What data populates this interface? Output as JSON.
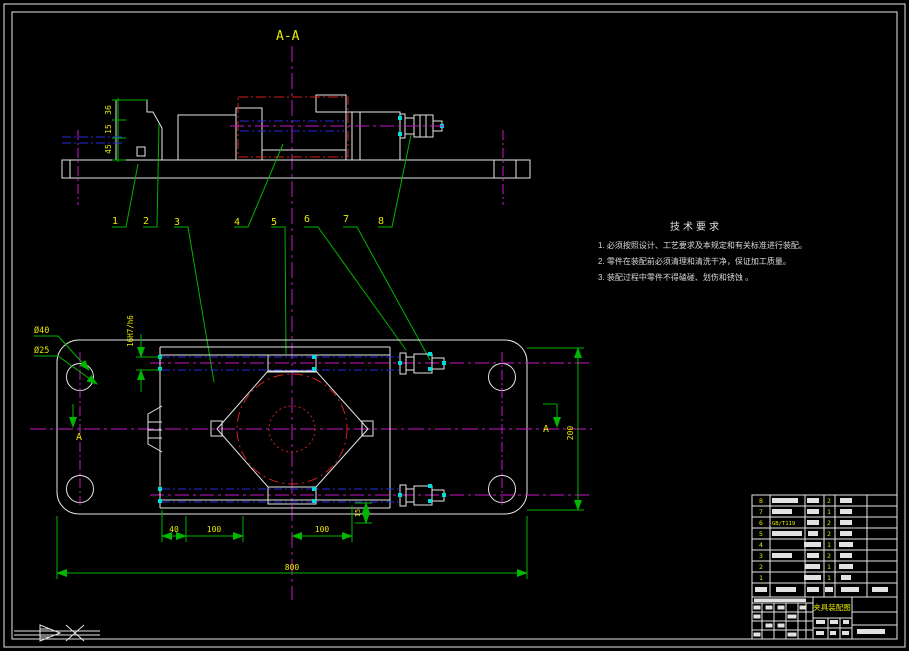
{
  "drawing": {
    "section_label": "A-A",
    "cut_label": "A",
    "part_numbers": [
      "1",
      "2",
      "3",
      "4",
      "5",
      "6",
      "7",
      "8"
    ],
    "dimensions": {
      "clamp_h_top": "36",
      "clamp_h_mid": "15",
      "clamp_h_bot": "45",
      "fit": "16H7/h6",
      "hole_outer": "Ø40",
      "hole_inner": "Ø25",
      "plate_height": "200",
      "offset_left": "40",
      "span_left": "100",
      "span_right": "100",
      "plate_width": "800",
      "rod_offset": "15"
    },
    "tech_requirements": {
      "title": "技术要求",
      "items": [
        "1. 必须按照设计、工艺要求及本规定和有关标准进行装配。",
        "2. 零件在装配前必须清理和清洗干净，保证加工质量。",
        "3. 装配过程中零件不得磕碰、划伤和锈蚀 。"
      ]
    },
    "title_block": {
      "drawing_title": "夹具装配图",
      "bom": {
        "rows": [
          {
            "no": "8",
            "qty": "2"
          },
          {
            "no": "7",
            "qty": "1"
          },
          {
            "no": "6",
            "qty": "2",
            "name": "GB/T119"
          },
          {
            "no": "5",
            "qty": "2"
          },
          {
            "no": "4",
            "qty": "1"
          },
          {
            "no": "3",
            "qty": "2"
          },
          {
            "no": "2",
            "qty": "1"
          },
          {
            "no": "1",
            "qty": "1"
          }
        ]
      }
    },
    "colors": {
      "outline": "#e6e6e6",
      "centerline": "#c816c8",
      "dimension_green": "#00b400",
      "dim_text_yellow": "#e8e800",
      "hidden_blue": "#2a2ae0",
      "phantom_red": "#d02020",
      "hatch_cyan": "#55cccc",
      "grip_cyan": "#00dcdc"
    }
  }
}
